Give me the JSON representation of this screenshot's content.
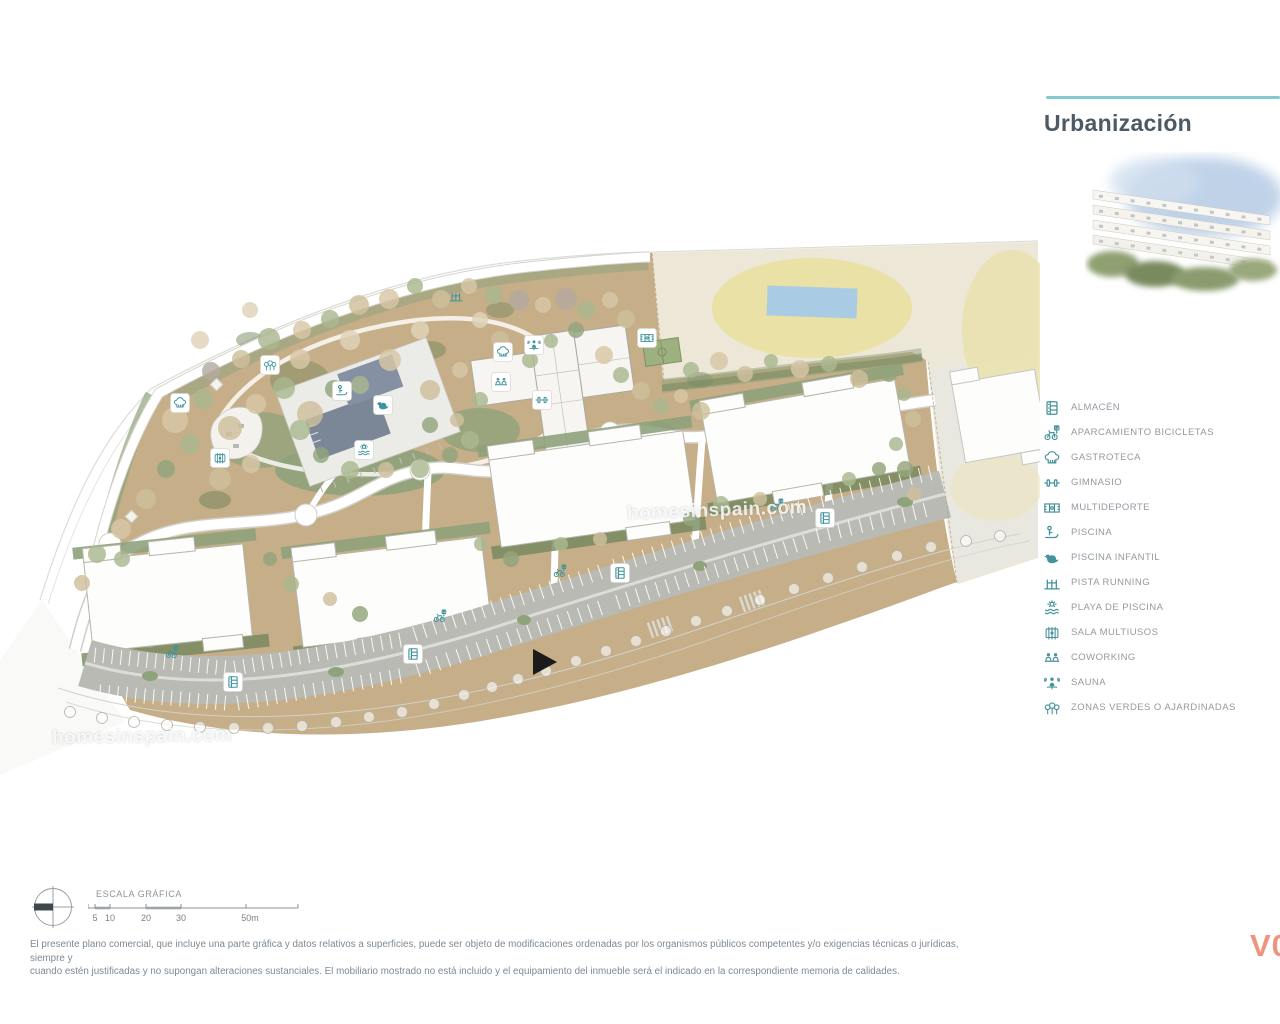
{
  "header": {
    "title": "Urbanización"
  },
  "legend": {
    "items": [
      {
        "icon": "almacen",
        "label": "ALMACÉN"
      },
      {
        "icon": "bicicletas",
        "label": "APARCAMIENTO BICICLETAS"
      },
      {
        "icon": "gastroteca",
        "label": "GASTROTECA"
      },
      {
        "icon": "gimnasio",
        "label": "GIMNASIO"
      },
      {
        "icon": "multideporte",
        "label": "MULTIDEPORTE"
      },
      {
        "icon": "piscina",
        "label": "PISCINA"
      },
      {
        "icon": "piscina-infantil",
        "label": "PISCINA INFANTIL"
      },
      {
        "icon": "pista-running",
        "label": "PISTA RUNNING"
      },
      {
        "icon": "playa-piscina",
        "label": "PLAYA DE PISCINA"
      },
      {
        "icon": "sala-multiusos",
        "label": "SALA MULTIUSOS"
      },
      {
        "icon": "coworking",
        "label": "COWORKING"
      },
      {
        "icon": "sauna",
        "label": "SAUNA"
      },
      {
        "icon": "zonas-verdes",
        "label": "ZONAS VERDES O AJARDINADAS"
      }
    ]
  },
  "scale_bar": {
    "label": "ESCALA GRÁFICA",
    "ticks": [
      "5",
      "10",
      "20",
      "30",
      "50m"
    ]
  },
  "watermark": {
    "text": "homesinspain.com"
  },
  "disclaimer": {
    "line1": "El presente plano comercial, que incluye una parte gráfica y datos relativos a superficies, puede ser objeto de modificaciones ordenadas por los organismos públicos competentes y/o exigencias técnicas o jurídicas, siempre y",
    "line2": "cuando estén justificadas y no supongan alteraciones sustanciales. El mobiliario mostrado no está incluido y el equipamiento del inmueble será el indicado en la correspondiente memoria de calidades."
  },
  "version_label": "V0",
  "colors": {
    "accent_teal": "#44929b",
    "accent_line": "#85c8ce",
    "title": "#4b5a64",
    "version": "#ee9480",
    "ground_tan": "#c6ae88",
    "green": "#8ea27b",
    "green_dark": "#74875c",
    "parking_gray": "#b9bab3",
    "pool_slate": "#7b8697",
    "neighbor_cream": "#ece7d7",
    "neighbor_pool_blue": "#a9cbe3"
  },
  "map": {
    "entrance_marker": {
      "x": 543,
      "y": 662
    },
    "icons": [
      {
        "icon": "gastroteca",
        "x": 180,
        "y": 403,
        "boxed": true
      },
      {
        "icon": "zonas-verdes",
        "x": 270,
        "y": 365,
        "boxed": true
      },
      {
        "icon": "pista-running",
        "x": 456,
        "y": 296,
        "boxed": false
      },
      {
        "icon": "sala-multiusos",
        "x": 220,
        "y": 458,
        "boxed": true
      },
      {
        "icon": "gastroteca",
        "x": 503,
        "y": 352,
        "boxed": true
      },
      {
        "icon": "sauna",
        "x": 534,
        "y": 345,
        "boxed": true
      },
      {
        "icon": "coworking",
        "x": 501,
        "y": 382,
        "boxed": true
      },
      {
        "icon": "gimnasio",
        "x": 542,
        "y": 400,
        "boxed": true
      },
      {
        "icon": "multideporte",
        "x": 647,
        "y": 338,
        "boxed": true
      },
      {
        "icon": "piscina",
        "x": 342,
        "y": 391,
        "boxed": true
      },
      {
        "icon": "piscina-infantil",
        "x": 383,
        "y": 405,
        "boxed": true
      },
      {
        "icon": "playa-piscina",
        "x": 364,
        "y": 450,
        "boxed": true
      },
      {
        "icon": "bicicletas",
        "x": 172,
        "y": 652,
        "boxed": false
      },
      {
        "icon": "bicicletas",
        "x": 440,
        "y": 616,
        "boxed": false
      },
      {
        "icon": "bicicletas",
        "x": 560,
        "y": 571,
        "boxed": false
      },
      {
        "icon": "bicicletas",
        "x": 777,
        "y": 505,
        "boxed": false
      },
      {
        "icon": "almacen",
        "x": 233,
        "y": 682,
        "boxed": true
      },
      {
        "icon": "almacen",
        "x": 413,
        "y": 654,
        "boxed": true
      },
      {
        "icon": "almacen",
        "x": 620,
        "y": 573,
        "boxed": true
      },
      {
        "icon": "almacen",
        "x": 825,
        "y": 518,
        "boxed": true
      }
    ],
    "tree_palette": [
      "#d8c7a6",
      "#cfc09c",
      "#aab890",
      "#93a57c",
      "#b5aa9f",
      "#e0d4b8"
    ],
    "trees": [
      [
        175,
        420,
        13,
        0
      ],
      [
        203,
        399,
        10,
        2
      ],
      [
        230,
        428,
        12,
        1
      ],
      [
        256,
        404,
        10,
        0
      ],
      [
        284,
        388,
        11,
        2
      ],
      [
        310,
        414,
        13,
        1
      ],
      [
        334,
        389,
        9,
        3
      ],
      [
        300,
        359,
        10,
        0
      ],
      [
        269,
        339,
        11,
        2
      ],
      [
        241,
        359,
        9,
        1
      ],
      [
        211,
        371,
        9,
        4
      ],
      [
        190,
        444,
        10,
        2
      ],
      [
        220,
        479,
        11,
        1
      ],
      [
        251,
        464,
        9,
        0
      ],
      [
        166,
        469,
        9,
        3
      ],
      [
        146,
        499,
        10,
        1
      ],
      [
        121,
        529,
        10,
        0
      ],
      [
        97,
        554,
        9,
        2
      ],
      [
        82,
        583,
        8,
        1
      ],
      [
        302,
        330,
        9,
        0
      ],
      [
        330,
        319,
        9,
        2
      ],
      [
        359,
        305,
        10,
        1
      ],
      [
        389,
        299,
        10,
        0
      ],
      [
        415,
        286,
        8,
        2
      ],
      [
        441,
        299,
        9,
        1
      ],
      [
        469,
        286,
        8,
        0
      ],
      [
        494,
        295,
        9,
        2
      ],
      [
        519,
        300,
        10,
        4
      ],
      [
        543,
        305,
        8,
        0
      ],
      [
        566,
        299,
        11,
        4
      ],
      [
        586,
        310,
        9,
        2
      ],
      [
        610,
        300,
        8,
        0
      ],
      [
        626,
        319,
        9,
        1
      ],
      [
        576,
        330,
        8,
        3
      ],
      [
        551,
        341,
        7,
        2
      ],
      [
        300,
        430,
        10,
        2
      ],
      [
        321,
        455,
        8,
        3
      ],
      [
        350,
        470,
        9,
        2
      ],
      [
        386,
        470,
        8,
        1
      ],
      [
        420,
        469,
        9,
        2
      ],
      [
        450,
        455,
        8,
        3
      ],
      [
        470,
        440,
        9,
        2
      ],
      [
        457,
        420,
        7,
        1
      ],
      [
        604,
        355,
        9,
        0
      ],
      [
        621,
        375,
        8,
        2
      ],
      [
        641,
        391,
        9,
        1
      ],
      [
        661,
        406,
        8,
        2
      ],
      [
        681,
        396,
        7,
        0
      ],
      [
        701,
        411,
        9,
        1
      ],
      [
        691,
        370,
        8,
        2
      ],
      [
        719,
        361,
        9,
        0
      ],
      [
        745,
        374,
        8,
        1
      ],
      [
        771,
        361,
        7,
        2
      ],
      [
        800,
        369,
        9,
        0
      ],
      [
        829,
        364,
        8,
        2
      ],
      [
        859,
        379,
        9,
        1
      ],
      [
        889,
        374,
        8,
        3
      ],
      [
        904,
        394,
        7,
        2
      ],
      [
        913,
        419,
        8,
        1
      ],
      [
        896,
        444,
        7,
        2
      ],
      [
        905,
        469,
        8,
        3
      ],
      [
        914,
        494,
        7,
        1
      ],
      [
        122,
        559,
        8,
        2
      ],
      [
        270,
        559,
        7,
        3
      ],
      [
        291,
        584,
        8,
        2
      ],
      [
        330,
        599,
        7,
        1
      ],
      [
        360,
        614,
        8,
        3
      ],
      [
        481,
        544,
        7,
        2
      ],
      [
        511,
        559,
        8,
        3
      ],
      [
        561,
        544,
        7,
        2
      ],
      [
        600,
        539,
        7,
        1
      ],
      [
        690,
        519,
        7,
        3
      ],
      [
        721,
        504,
        8,
        2
      ],
      [
        760,
        499,
        7,
        1
      ],
      [
        849,
        479,
        7,
        2
      ],
      [
        879,
        469,
        7,
        3
      ],
      [
        250,
        310,
        8,
        5
      ],
      [
        200,
        340,
        9,
        5
      ],
      [
        350,
        340,
        10,
        5
      ],
      [
        420,
        330,
        9,
        5
      ],
      [
        480,
        320,
        8,
        5
      ],
      [
        390,
        360,
        11,
        0
      ],
      [
        360,
        385,
        9,
        2
      ],
      [
        430,
        390,
        10,
        1
      ],
      [
        460,
        370,
        8,
        0
      ],
      [
        500,
        340,
        9,
        1
      ],
      [
        530,
        360,
        8,
        2
      ],
      [
        480,
        400,
        8,
        2
      ],
      [
        430,
        425,
        8,
        3
      ]
    ],
    "street_trees": [
      [
        70,
        712
      ],
      [
        102,
        718
      ],
      [
        134,
        722
      ],
      [
        167,
        725
      ],
      [
        200,
        727
      ],
      [
        234,
        728
      ],
      [
        268,
        728
      ],
      [
        302,
        726
      ],
      [
        336,
        722
      ],
      [
        369,
        717
      ],
      [
        402,
        712
      ],
      [
        434,
        704
      ],
      [
        464,
        695
      ],
      [
        492,
        687
      ],
      [
        518,
        679
      ],
      [
        546,
        671
      ],
      [
        576,
        661
      ],
      [
        606,
        651
      ],
      [
        636,
        641
      ],
      [
        666,
        631
      ],
      [
        696,
        621
      ],
      [
        727,
        611
      ],
      [
        760,
        600
      ],
      [
        794,
        589
      ],
      [
        828,
        578
      ],
      [
        862,
        567
      ],
      [
        897,
        556
      ],
      [
        931,
        547
      ],
      [
        966,
        541
      ],
      [
        1000,
        536
      ]
    ],
    "parking_stall_rows": [
      {
        "x1": 95,
        "y1": 655,
        "x2": 225,
        "y2": 668,
        "n": 16
      },
      {
        "x1": 235,
        "y1": 668,
        "x2": 400,
        "y2": 640,
        "n": 19
      },
      {
        "x1": 415,
        "y1": 634,
        "x2": 600,
        "y2": 572,
        "n": 20
      },
      {
        "x1": 615,
        "y1": 566,
        "x2": 810,
        "y2": 505,
        "n": 21
      },
      {
        "x1": 822,
        "y1": 500,
        "x2": 930,
        "y2": 473,
        "n": 12
      },
      {
        "x1": 100,
        "y1": 692,
        "x2": 225,
        "y2": 703,
        "n": 15
      },
      {
        "x1": 238,
        "y1": 703,
        "x2": 400,
        "y2": 676,
        "n": 18
      },
      {
        "x1": 418,
        "y1": 670,
        "x2": 600,
        "y2": 608,
        "n": 19
      },
      {
        "x1": 618,
        "y1": 602,
        "x2": 805,
        "y2": 542,
        "n": 20
      },
      {
        "x1": 818,
        "y1": 536,
        "x2": 925,
        "y2": 510,
        "n": 11
      }
    ]
  }
}
